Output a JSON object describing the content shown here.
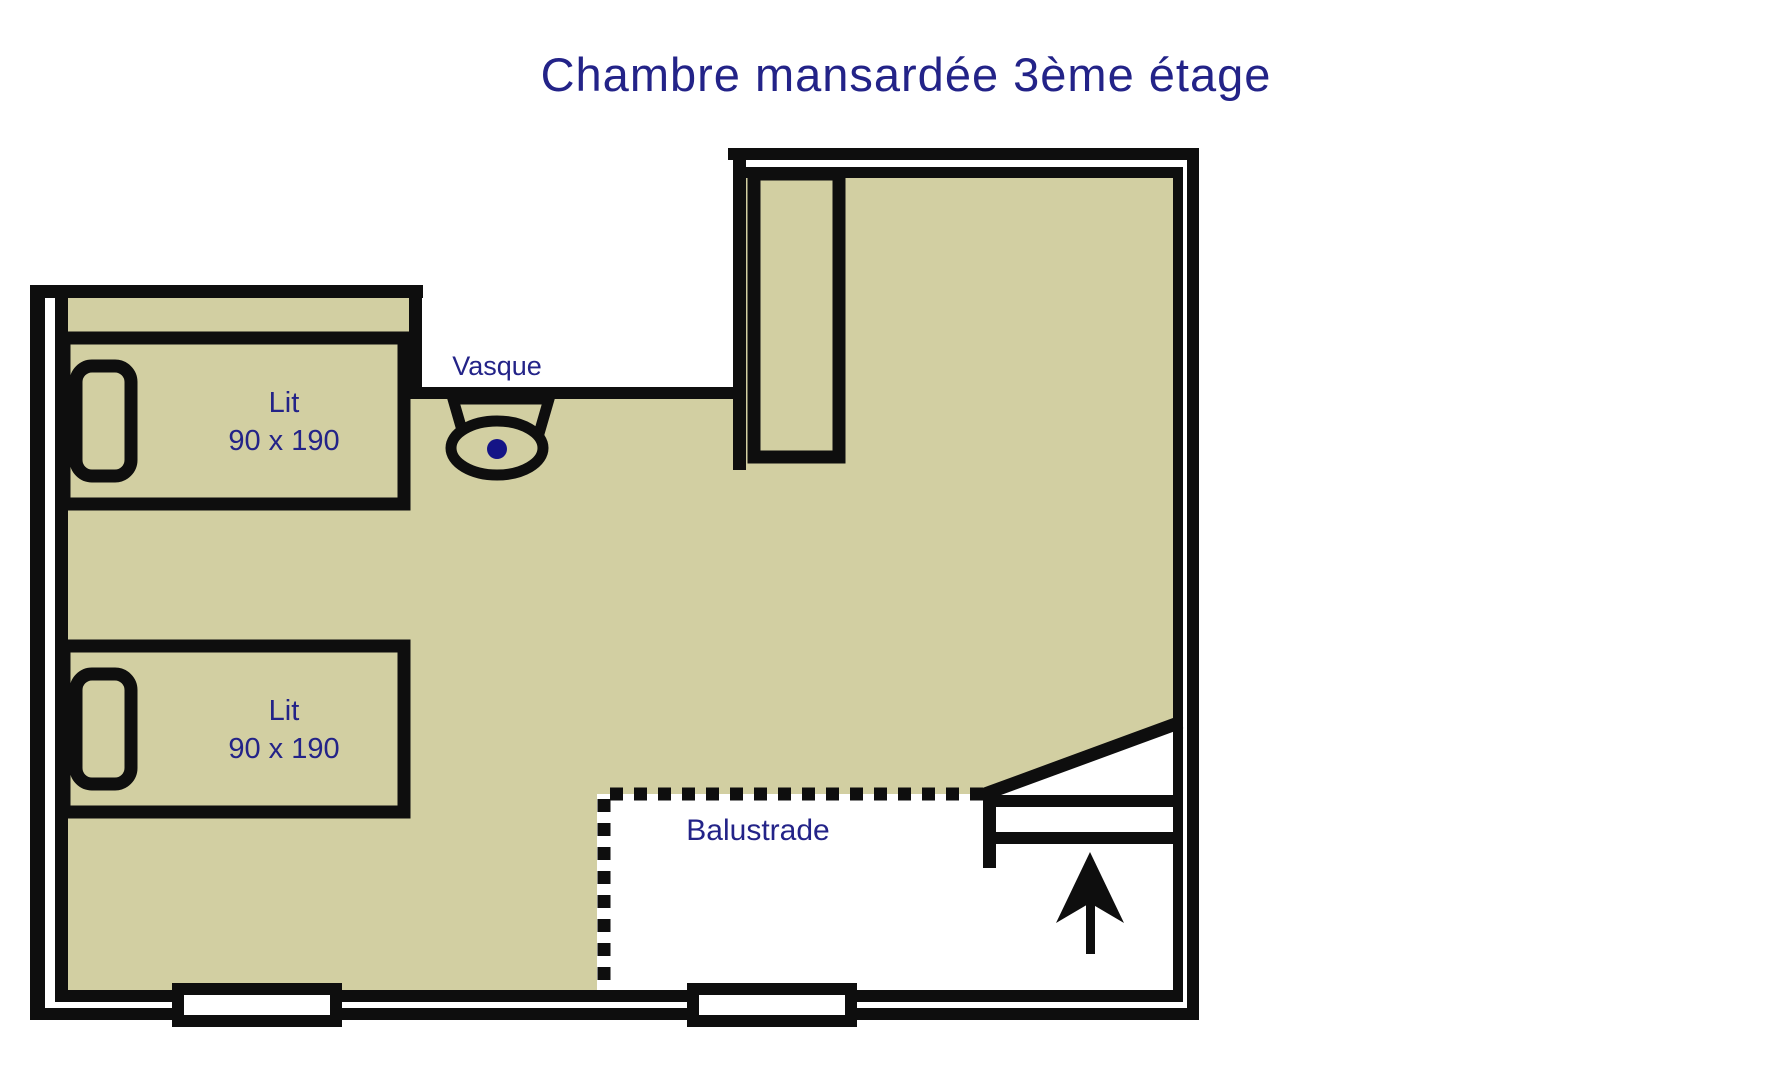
{
  "title": "Chambre mansardée 3ème étage",
  "labels": {
    "sink": "Vasque",
    "balustrade": "Balustrade",
    "bed1": {
      "name": "Lit",
      "dimensions": "90 x 190"
    },
    "bed2": {
      "name": "Lit",
      "dimensions": "90 x 190"
    }
  },
  "colors": {
    "floor": "#d2cfa2",
    "wall": "#0e0e0e",
    "text": "#232388",
    "accent_dot": "#141486",
    "background": "#ffffff"
  }
}
